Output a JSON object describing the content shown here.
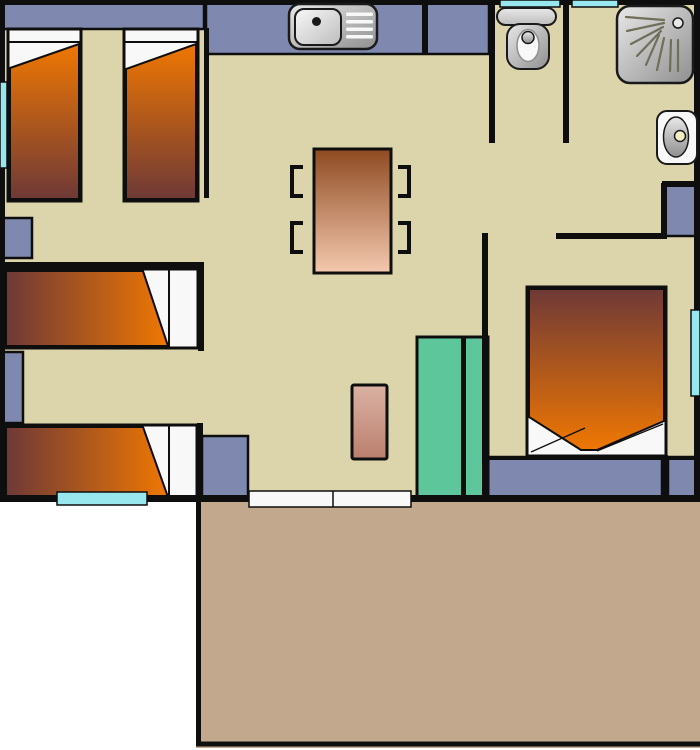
{
  "diagram": {
    "type": "floor-plan",
    "fixtures": [
      "single-bed-vertical-icon",
      "single-bed-vertical-icon",
      "single-bed-horizontal-icon",
      "single-bed-horizontal-icon",
      "double-bed-icon",
      "kitchen-sink-icon",
      "dining-table-icon",
      "chair-bracket-icon",
      "toilet-icon",
      "shower-icon",
      "washbasin-icon",
      "wardrobe-icon",
      "bench-icon",
      "rug-icon",
      "window-icon",
      "sliding-door-icon",
      "terrace-deck-icon"
    ]
  },
  "colors": {
    "outside": "#ffffff",
    "floor": "#dcd5ac",
    "wall": "#0e0e0e",
    "furnitureBlue": "#7f88ae",
    "wardrobeGreen": "#5ec69b",
    "windowCyan": "#98e6ee",
    "terrace": "#c2a98d",
    "orange": "#ef7702",
    "maroon": "#6e3937",
    "tableDark": "#8e4a21",
    "tableLight": "#f4c9af",
    "rugLight": "#dab2a3",
    "rugDark": "#ba7f6e",
    "metalLight": "#e8e8e8",
    "metalMid": "#bdbdbd",
    "metalDark": "#8f8f8f",
    "fixtureWhite": "#f8f8f8",
    "sprayLine": "#6f6f5a",
    "drainCream": "#f1ecc2",
    "stroke": "#1a1a1a"
  }
}
